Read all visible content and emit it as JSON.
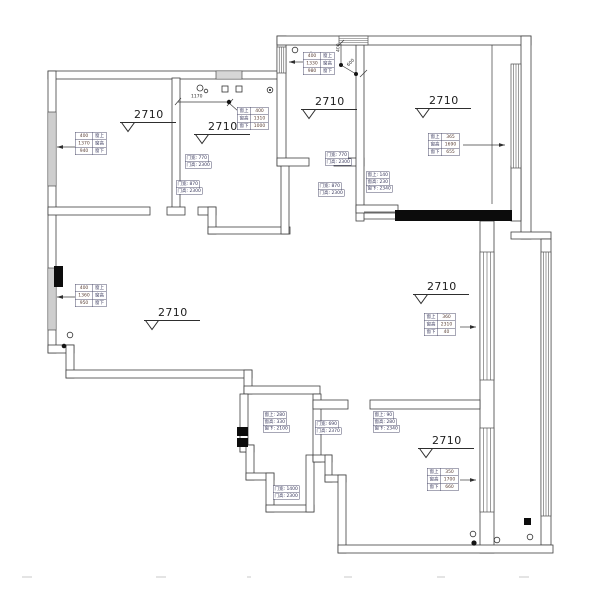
{
  "plan": {
    "elevation_label": "2710",
    "markers": [
      {
        "pos": [
          120,
          108
        ]
      },
      {
        "pos": [
          194,
          120
        ]
      },
      {
        "pos": [
          301,
          95
        ]
      },
      {
        "pos": [
          415,
          94
        ]
      },
      {
        "pos": [
          144,
          306
        ]
      },
      {
        "pos": [
          413,
          280
        ]
      },
      {
        "pos": [
          418,
          434
        ]
      }
    ],
    "window_tables": [
      {
        "pos": [
          75,
          132
        ],
        "rows": [
          [
            "400",
            "窗上"
          ],
          [
            "1370",
            "窗高"
          ],
          [
            "940",
            "窗下"
          ]
        ]
      },
      {
        "pos": [
          237,
          107
        ],
        "rows": [
          [
            "窗上",
            "400"
          ],
          [
            "窗高",
            "1310"
          ],
          [
            "窗下",
            "1000"
          ]
        ]
      },
      {
        "pos": [
          303,
          52
        ],
        "rows": [
          [
            "400",
            "窗上"
          ],
          [
            "1330",
            "窗高"
          ],
          [
            "980",
            "窗下"
          ]
        ]
      },
      {
        "pos": [
          428,
          133
        ],
        "rows": [
          [
            "窗上",
            "365"
          ],
          [
            "窗高",
            "1690"
          ],
          [
            "窗下",
            "655"
          ]
        ]
      },
      {
        "pos": [
          75,
          284
        ],
        "rows": [
          [
            "400",
            "窗上"
          ],
          [
            "1360",
            "窗高"
          ],
          [
            "950",
            "窗下"
          ]
        ]
      },
      {
        "pos": [
          424,
          313
        ],
        "rows": [
          [
            "窗上",
            "360"
          ],
          [
            "窗高",
            "2310"
          ],
          [
            "窗下",
            "40"
          ]
        ]
      },
      {
        "pos": [
          427,
          468
        ],
        "rows": [
          [
            "窗上",
            "350"
          ],
          [
            "窗高",
            "1700"
          ],
          [
            "窗下",
            "660"
          ]
        ]
      }
    ],
    "callouts": [
      {
        "pos": [
          185,
          155
        ],
        "lines": [
          "门宽: 770",
          "门高: 2300"
        ]
      },
      {
        "pos": [
          176,
          181
        ],
        "lines": [
          "门宽: 870",
          "门高: 2300"
        ]
      },
      {
        "pos": [
          325,
          152
        ],
        "lines": [
          "门宽: 770",
          "门高: 2300"
        ]
      },
      {
        "pos": [
          318,
          183
        ],
        "lines": [
          "门宽: 870",
          "门高: 2300"
        ]
      },
      {
        "pos": [
          366,
          172
        ],
        "lines": [
          "窗上: 140",
          "窗高: 230",
          "窗下: 2340"
        ]
      },
      {
        "pos": [
          263,
          412
        ],
        "lines": [
          "窗上: 280",
          "窗高: 330",
          "窗下: 2100"
        ]
      },
      {
        "pos": [
          373,
          412
        ],
        "lines": [
          "窗上: 90",
          "窗高: 280",
          "窗下: 2340"
        ]
      },
      {
        "pos": [
          315,
          421
        ],
        "lines": [
          "门宽: 690",
          "门高: 2370"
        ]
      },
      {
        "pos": [
          273,
          486
        ],
        "lines": [
          "门宽: 1400",
          "门高: 2300"
        ]
      }
    ],
    "dims": [
      {
        "pos": [
          191,
          94
        ],
        "text": "1170",
        "rot": 0
      },
      {
        "pos": [
          336,
          52
        ],
        "text": "400",
        "rot": -90
      },
      {
        "pos": [
          346,
          64
        ],
        "text": "600",
        "rot": -45
      }
    ]
  }
}
